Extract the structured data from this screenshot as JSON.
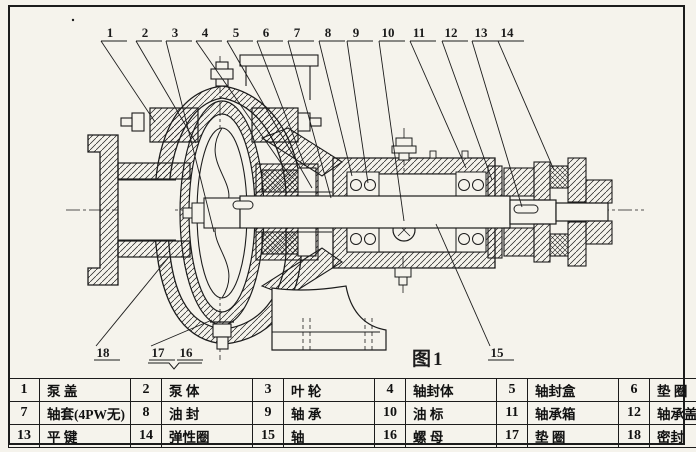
{
  "figure": {
    "caption": "图1"
  },
  "colors": {
    "ink": "#1c1c1c",
    "paper": "#f5f3ec"
  },
  "callouts": {
    "top": [
      {
        "label": "1",
        "x": 110,
        "tx": 155,
        "ty": 122
      },
      {
        "label": "2",
        "x": 145,
        "tx": 196,
        "ty": 143
      },
      {
        "label": "3",
        "x": 175,
        "tx": 214,
        "ty": 232
      },
      {
        "label": "4",
        "x": 205,
        "tx": 290,
        "ty": 176
      },
      {
        "label": "5",
        "x": 236,
        "tx": 312,
        "ty": 188
      },
      {
        "label": "6",
        "x": 266,
        "tx": 305,
        "ty": 166
      },
      {
        "label": "7",
        "x": 297,
        "tx": 331,
        "ty": 198
      },
      {
        "label": "8",
        "x": 328,
        "tx": 352,
        "ty": 176
      },
      {
        "label": "9",
        "x": 356,
        "tx": 368,
        "ty": 183
      },
      {
        "label": "10",
        "x": 388,
        "tx": 404,
        "ty": 221
      },
      {
        "label": "11",
        "x": 419,
        "tx": 466,
        "ty": 168
      },
      {
        "label": "12",
        "x": 451,
        "tx": 492,
        "ty": 180
      },
      {
        "label": "13",
        "x": 481,
        "tx": 522,
        "ty": 207
      },
      {
        "label": "14",
        "x": 507,
        "tx": 554,
        "ty": 170
      }
    ],
    "bottom": [
      {
        "label": "18",
        "x": 103,
        "tx": 168,
        "ty": 258
      },
      {
        "label": "17",
        "x": 158,
        "tx": 212,
        "ty": 320
      },
      {
        "label": "16",
        "x": 186,
        "tx": null,
        "ty": null
      },
      {
        "label": "15",
        "x": 497,
        "tx": 436,
        "ty": 224
      }
    ],
    "brace_16_17": {
      "x1": 148,
      "x2": 202,
      "y": 363,
      "dipx": 174,
      "dipy": 369
    }
  },
  "parts_table": {
    "rows": [
      [
        {
          "no": "1",
          "name": "泵 盖"
        },
        {
          "no": "2",
          "name": "泵 体"
        },
        {
          "no": "3",
          "name": "叶 轮"
        },
        {
          "no": "4",
          "name": "轴封体"
        },
        {
          "no": "5",
          "name": "轴封盒"
        },
        {
          "no": "6",
          "name": "垫 圈"
        }
      ],
      [
        {
          "no": "7",
          "name": "轴套(4PW无)"
        },
        {
          "no": "8",
          "name": "油 封"
        },
        {
          "no": "9",
          "name": "轴 承"
        },
        {
          "no": "10",
          "name": "油 标"
        },
        {
          "no": "11",
          "name": "轴承箱"
        },
        {
          "no": "12",
          "name": "轴承盖"
        }
      ],
      [
        {
          "no": "13",
          "name": "平 键"
        },
        {
          "no": "14",
          "name": "弹性圈"
        },
        {
          "no": "15",
          "name": "轴"
        },
        {
          "no": "16",
          "name": "螺 母"
        },
        {
          "no": "17",
          "name": "垫 圈"
        },
        {
          "no": "18",
          "name": "密封"
        }
      ]
    ]
  }
}
